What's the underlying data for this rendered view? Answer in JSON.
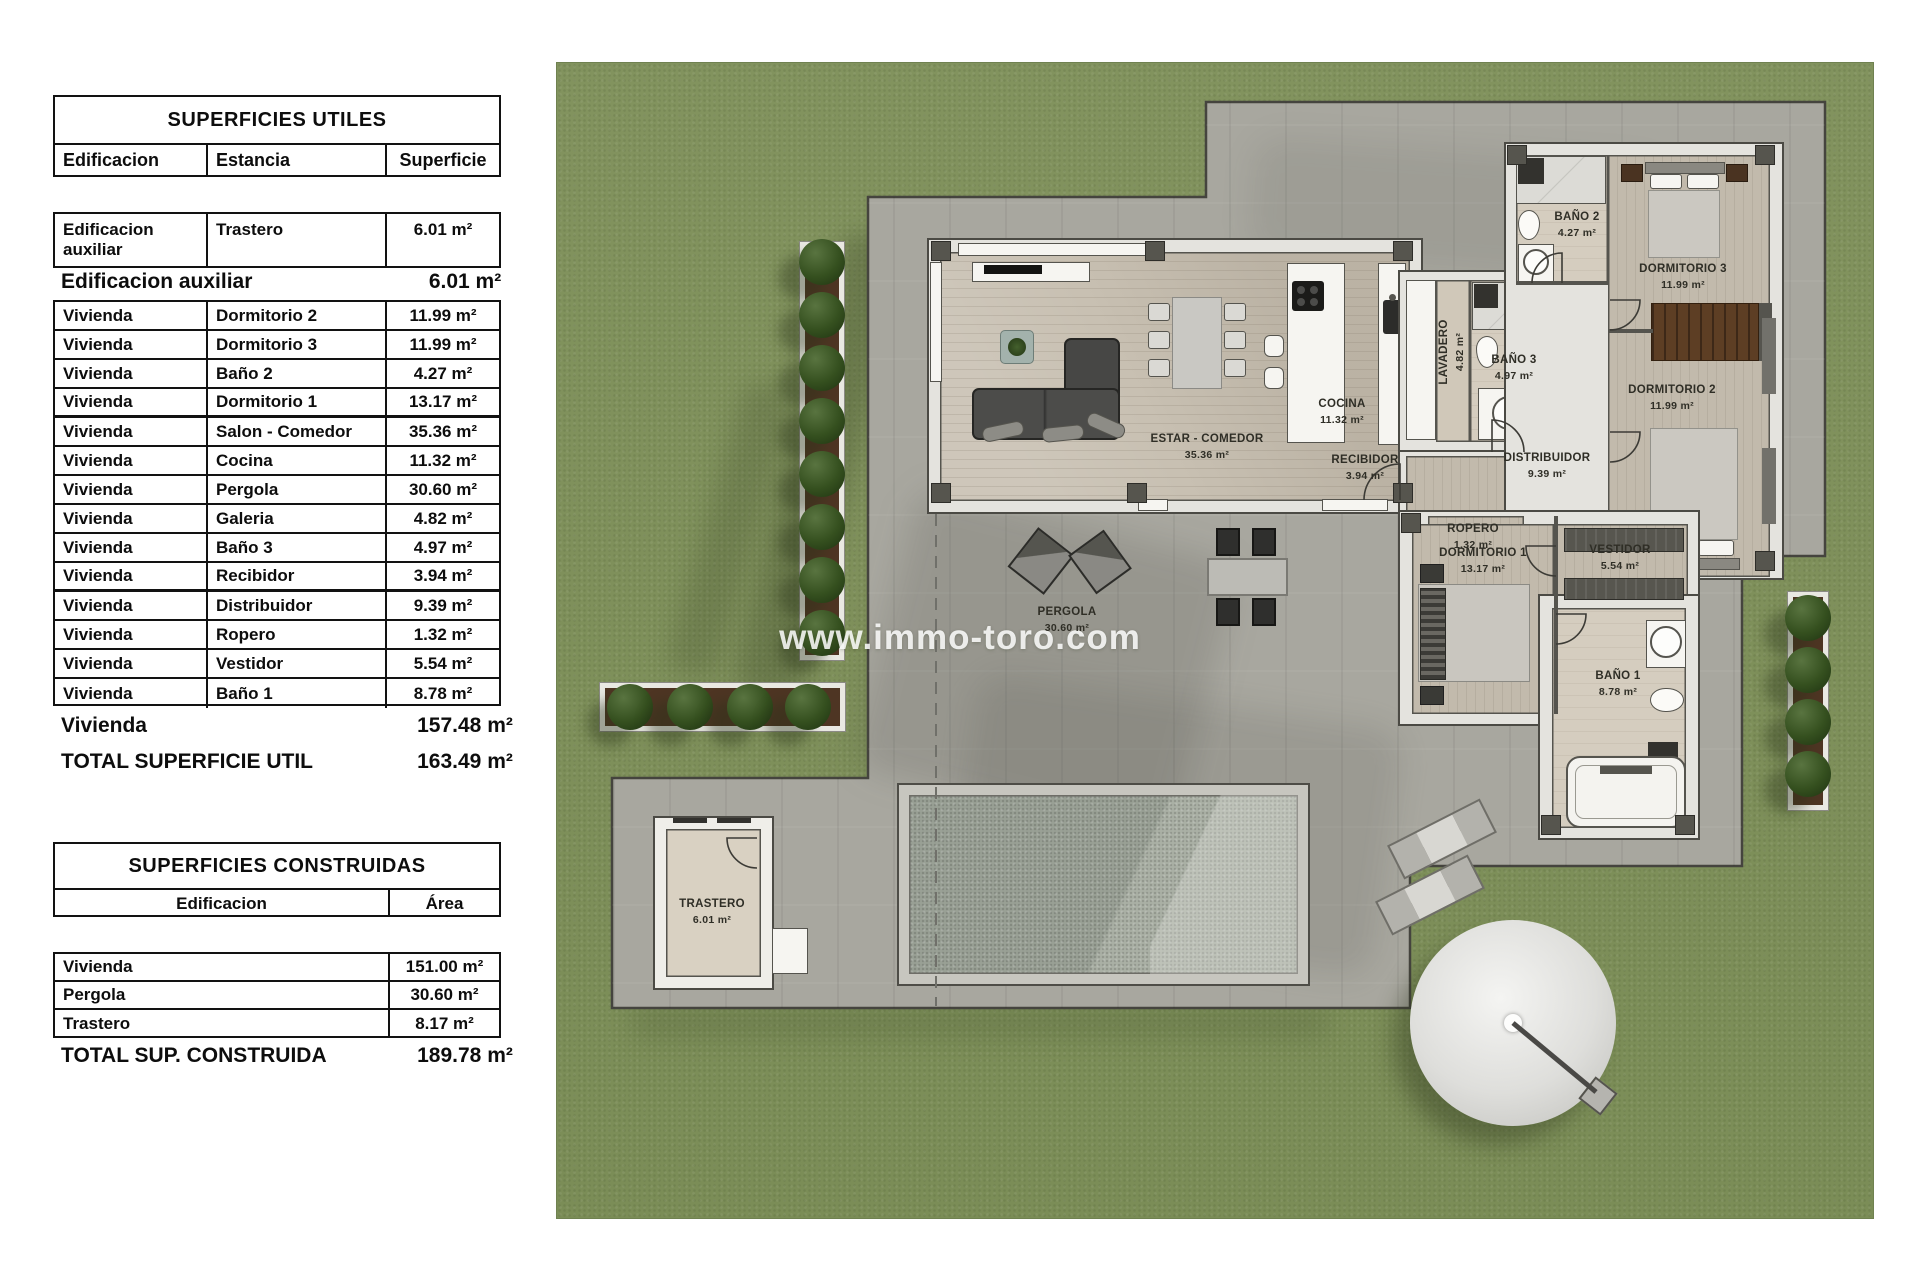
{
  "tables": {
    "utiles": {
      "title": "SUPERFICIES UTILES",
      "col_edificacion": "Edificacion",
      "col_estancia": "Estancia",
      "col_superficie": "Superficie",
      "aux_row": {
        "e": "Edificacion auxiliar",
        "s": "Trastero",
        "v": "6.01 m²"
      },
      "aux_summary_label": "Edificacion auxiliar",
      "aux_summary_value": "6.01 m²",
      "rows": [
        {
          "e": "Vivienda",
          "s": "Dormitorio 2",
          "v": "11.99 m²"
        },
        {
          "e": "Vivienda",
          "s": "Dormitorio 3",
          "v": "11.99 m²"
        },
        {
          "e": "Vivienda",
          "s": "Baño 2",
          "v": "4.27 m²"
        },
        {
          "e": "Vivienda",
          "s": "Dormitorio 1",
          "v": "13.17 m²"
        },
        {
          "e": "Vivienda",
          "s": "Salon - Comedor",
          "v": "35.36 m²"
        },
        {
          "e": "Vivienda",
          "s": "Cocina",
          "v": "11.32 m²"
        },
        {
          "e": "Vivienda",
          "s": "Pergola",
          "v": "30.60 m²"
        },
        {
          "e": "Vivienda",
          "s": "Galeria",
          "v": "4.82 m²"
        },
        {
          "e": "Vivienda",
          "s": "Baño 3",
          "v": "4.97 m²"
        },
        {
          "e": "Vivienda",
          "s": "Recibidor",
          "v": "3.94 m²"
        },
        {
          "e": "Vivienda",
          "s": "Distribuidor",
          "v": "9.39 m²"
        },
        {
          "e": "Vivienda",
          "s": "Ropero",
          "v": "1.32 m²"
        },
        {
          "e": "Vivienda",
          "s": "Vestidor",
          "v": "5.54 m²"
        },
        {
          "e": "Vivienda",
          "s": "Baño 1",
          "v": "8.78 m²"
        }
      ],
      "vivienda_summary_label": "Vivienda",
      "vivienda_summary_value": "157.48 m²",
      "total_label": "TOTAL SUPERFICIE UTIL",
      "total_value": "163.49 m²"
    },
    "construidas": {
      "title": "SUPERFICIES CONSTRUIDAS",
      "col_edificacion": "Edificacion",
      "col_area": "Área",
      "rows": [
        {
          "e": "Vivienda",
          "v": "151.00 m²"
        },
        {
          "e": "Pergola",
          "v": "30.60 m²"
        },
        {
          "e": "Trastero",
          "v": "8.17 m²"
        }
      ],
      "total_label": "TOTAL SUP. CONSTRUIDA",
      "total_value": "189.78 m²"
    }
  },
  "plan": {
    "watermark": "www.immo-toro.com",
    "rooms": {
      "estar": {
        "name": "ESTAR - COMEDOR",
        "area": "35.36 m²"
      },
      "cocina": {
        "name": "COCINA",
        "area": "11.32 m²"
      },
      "lavadero": {
        "name": "LAVADERO",
        "area": "4.82 m²"
      },
      "bano3": {
        "name": "BAÑO 3",
        "area": "4.97 m²"
      },
      "bano2": {
        "name": "BAÑO 2",
        "area": "4.27 m²"
      },
      "dorm3": {
        "name": "DORMITORIO 3",
        "area": "11.99 m²"
      },
      "dorm2": {
        "name": "DORMITORIO 2",
        "area": "11.99 m²"
      },
      "recibidor": {
        "name": "RECIBIDOR",
        "area": "3.94 m²"
      },
      "distribuidor": {
        "name": "DISTRIBUIDOR",
        "area": "9.39 m²"
      },
      "ropero": {
        "name": "ROPERO",
        "area": "1.32 m²"
      },
      "dorm1": {
        "name": "DORMITORIO 1",
        "area": "13.17 m²"
      },
      "vestidor": {
        "name": "VESTIDOR",
        "area": "5.54 m²"
      },
      "bano1": {
        "name": "BAÑO 1",
        "area": "8.78 m²"
      },
      "pergola": {
        "name": "PERGOLA",
        "area": "30.60 m²"
      },
      "trastero": {
        "name": "TRASTERO",
        "area": "6.01 m²"
      }
    }
  },
  "colors": {
    "lawn": "#7e905b",
    "terrace": "#a8a79f",
    "tree": "#35501f",
    "pool": "#9aa096",
    "wall": "#e4e3de",
    "text": "#0d0d0d"
  }
}
